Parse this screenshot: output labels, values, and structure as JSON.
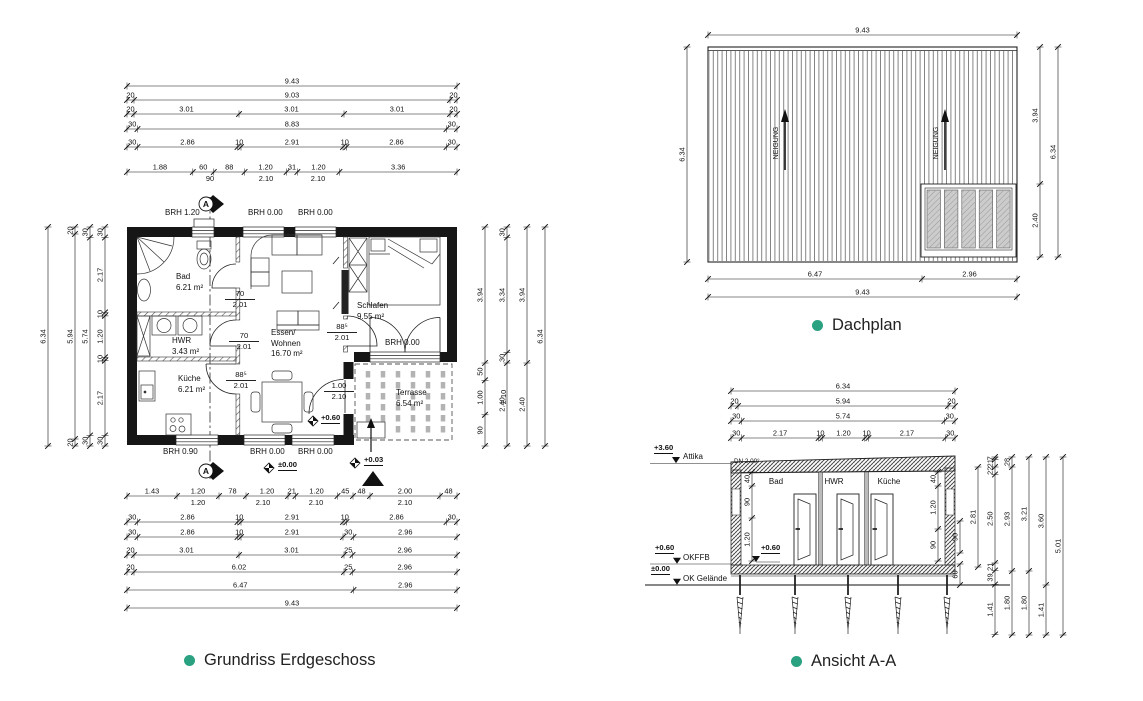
{
  "accent": "#2aa181",
  "captions": {
    "floor_plan": "Grundriss Erdgeschoss",
    "roof_plan": "Dachplan",
    "section": "Ansicht A-A"
  },
  "floor_plan": {
    "dims_top": [
      [
        "9.43"
      ],
      [
        "20",
        "9.03",
        "20"
      ],
      [
        "20",
        "3.01",
        "3.01",
        "3.01",
        "20"
      ],
      [
        "30",
        "8.83",
        "30"
      ],
      [
        "30",
        "2.86",
        "10",
        "2.91",
        "10",
        "2.86",
        "30"
      ],
      [
        "1.88",
        "60",
        "88",
        "1.20",
        "31",
        "1.20",
        "3.36"
      ]
    ],
    "dims_top_subs": [
      "90",
      "2.10",
      "2.10"
    ],
    "dims_bottom": [
      [
        "1.43",
        "1.20",
        "78",
        "1.20",
        "21",
        "1.20",
        "45",
        "48",
        "2.00",
        "48"
      ],
      [
        "30",
        "2.86",
        "10",
        "2.91",
        "10",
        "2.86",
        "30"
      ],
      [
        "30",
        "2.86",
        "10",
        "2.91",
        "30",
        "2.96"
      ],
      [
        "20",
        "3.01",
        "3.01",
        "25",
        "2.96"
      ],
      [
        "20",
        "6.02",
        "25",
        "2.96"
      ],
      [
        "6.47",
        "2.96"
      ],
      [
        "9.43"
      ]
    ],
    "dims_bottom_subs": [
      "1.20",
      "2.10",
      "2.10",
      "2.10"
    ],
    "dims_left": [
      [
        "6.34"
      ],
      [
        "20",
        "5.94",
        "20"
      ],
      [
        "30",
        "5.74",
        "30"
      ],
      [
        "30",
        "2.17",
        "10",
        "1.20",
        "10",
        "2.17",
        "30"
      ]
    ],
    "dims_right": [
      [
        "3.94",
        "50",
        "1.00",
        "90"
      ],
      [
        "30",
        "3.34",
        "30",
        "2.40"
      ],
      [
        "3.94",
        "2.40"
      ],
      [
        "6.34"
      ]
    ],
    "dims_right_sub": "2.10",
    "rooms": [
      {
        "name": "Bad",
        "area": "6.21 m²"
      },
      {
        "name": "HWR",
        "area": "3.43 m²"
      },
      {
        "name": "Küche",
        "area": "6.21 m²"
      },
      {
        "name": "Essen/",
        "name2": "Wohnen",
        "area": "16.70 m²"
      },
      {
        "name": "Schlafen",
        "area": "9.55 m²"
      },
      {
        "name": "Terrasse",
        "area": "6.54 m²"
      }
    ],
    "windows_top": [
      "BRH 1.20",
      "BRH 0.00",
      "BRH 0.00"
    ],
    "windows_bottom": [
      "BRH 0.90",
      "BRH 0.00",
      "BRH 0.00"
    ],
    "window_terrace": "BRH 0.00",
    "doors": [
      {
        "w": "70",
        "h": "2.01"
      },
      {
        "w": "70",
        "h": "2.01"
      },
      {
        "w": "88⁵",
        "h": "2.01"
      },
      {
        "w": "88⁵",
        "h": "2.01"
      },
      {
        "w": "1.00",
        "h": "2.10"
      }
    ],
    "levels": {
      "terrace_door": "+0.60",
      "entry": "±0.00",
      "outside": "+0.03"
    },
    "section_mark": "A"
  },
  "roof_plan": {
    "dims_top": [
      [
        "9.43"
      ]
    ],
    "dims_bottom": [
      [
        "6.47",
        "2.96"
      ],
      [
        "9.43"
      ]
    ],
    "dims_left": [
      [
        "6.34"
      ]
    ],
    "dims_right": [
      [
        "3.94",
        "2.40"
      ],
      [
        "6.34"
      ]
    ],
    "slope_label": "NEIGUNG"
  },
  "section": {
    "dims_top": [
      [
        "6.34"
      ],
      [
        "20",
        "5.94",
        "20"
      ],
      [
        "30",
        "5.74",
        "30"
      ],
      [
        "30",
        "2.17",
        "10",
        "1.20",
        "10",
        "2.17",
        "30"
      ]
    ],
    "dims_right": [
      [
        "2.81"
      ],
      [
        "7",
        "21",
        "22",
        "2.50",
        "21",
        "39",
        "1.41"
      ],
      [
        "28",
        "2.93",
        "1.80"
      ],
      [
        "3.21",
        "1.80"
      ],
      [
        "3.60",
        "1.41"
      ],
      [
        "5.01"
      ]
    ],
    "dims_inner_left": [
      "40",
      "90",
      "1.20"
    ],
    "dims_inner_right": [
      "40",
      "1.20",
      "90"
    ],
    "dims_outer_right": [
      "90",
      "60"
    ],
    "rooms": [
      "Bad",
      "HWR",
      "Küche"
    ],
    "levels": [
      {
        "value": "+3.60",
        "label": "Attika"
      },
      {
        "value": "+0.60",
        "label": "OKFFB"
      },
      {
        "value": "±0.00",
        "label": "OK Gelände"
      },
      {
        "value": "+0.60",
        "label": ""
      }
    ],
    "roof_slope": "DN 2.00°"
  }
}
